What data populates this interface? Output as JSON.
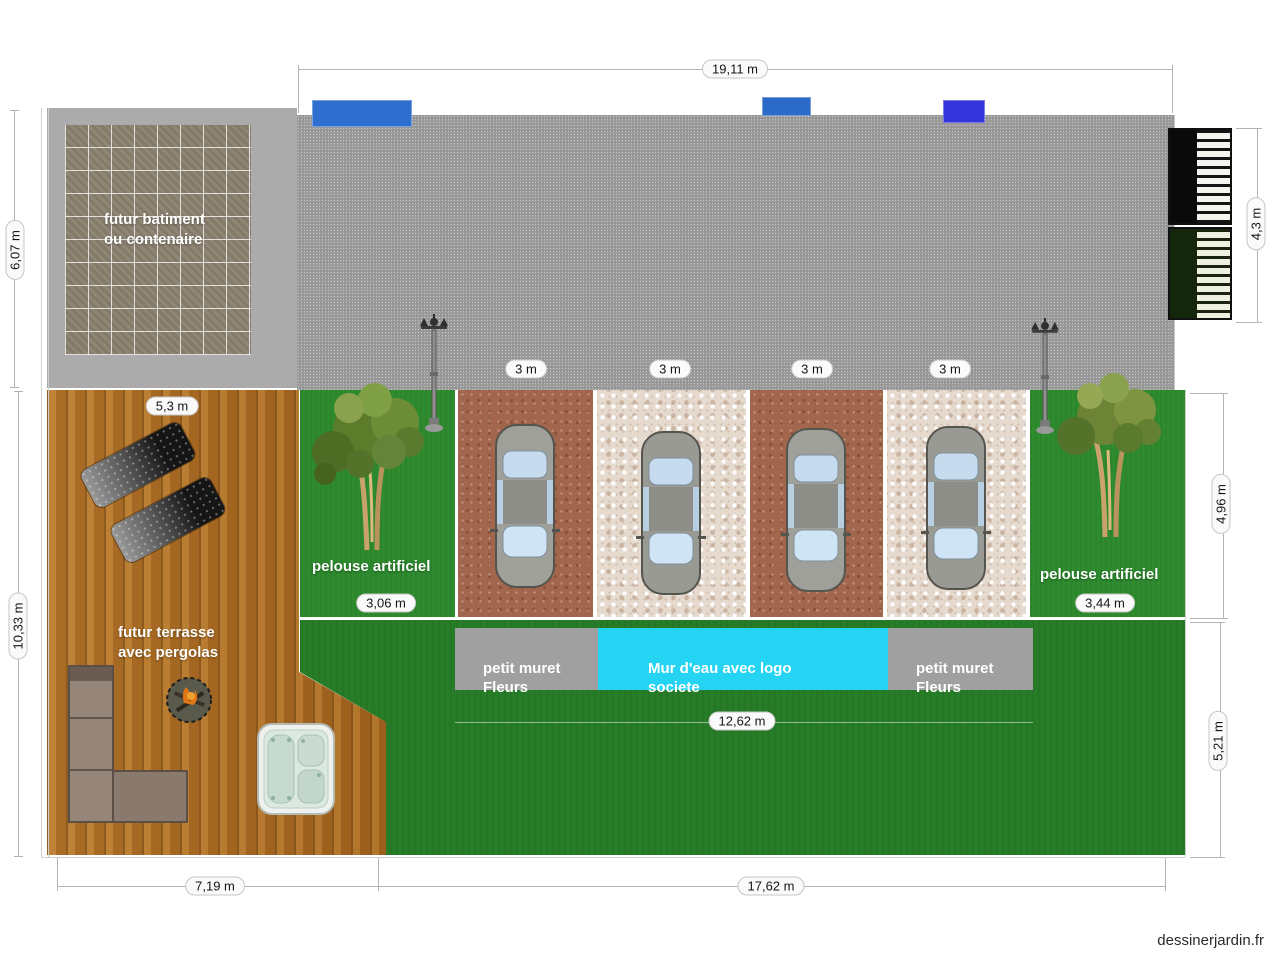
{
  "watermark": "dessinerjardin.fr",
  "dims": {
    "top": "19,11 m",
    "left_upper": "6,07 m",
    "left_lower": "10,33 m",
    "gate_height": "4,3 m",
    "deck_width": "5,3 m",
    "spots": [
      "3 m",
      "3 m",
      "3 m",
      "3 m"
    ],
    "lawn_left_width": "3,06 m",
    "lawn_right_width": "3,44 m",
    "parking_depth": "4,96 m",
    "water_wall_width": "12,62 m",
    "lawn_depth": "5,21 m",
    "bottom_left": "7,19 m",
    "bottom_right": "17,62 m"
  },
  "zones": {
    "building": {
      "label": "futur batiment\nou contenaire"
    },
    "terrace": {
      "label": "futur terrasse\navec pergolas"
    },
    "lawn_left": {
      "label": "pelouse artificiel"
    },
    "lawn_right": {
      "label": "pelouse artificiel"
    },
    "muret_left": {
      "label": "petit muret\nFleurs"
    },
    "water_wall": {
      "label": "Mur d'eau avec logo\nsociete"
    },
    "muret_right": {
      "label": "petit muret\nFleurs"
    }
  },
  "colors": {
    "asphalt": "#9b9b9b",
    "zone_gray": "#ababab",
    "tile": "#8b8170",
    "wood": "#ad6c24",
    "lawn_strip": "#2e8b2e",
    "lawn_main": "#277c27",
    "parking_brown": "#a2664c",
    "parking_gravel": "#e6dace",
    "muret_gray": "#a0a0a0",
    "water_wall_cyan": "#25d4f2",
    "panel_blue": "#2e6ece",
    "panel_blue_bright": "#3434dd",
    "car_body": "#a0a09a",
    "car_glass": "#cfe4f4"
  }
}
